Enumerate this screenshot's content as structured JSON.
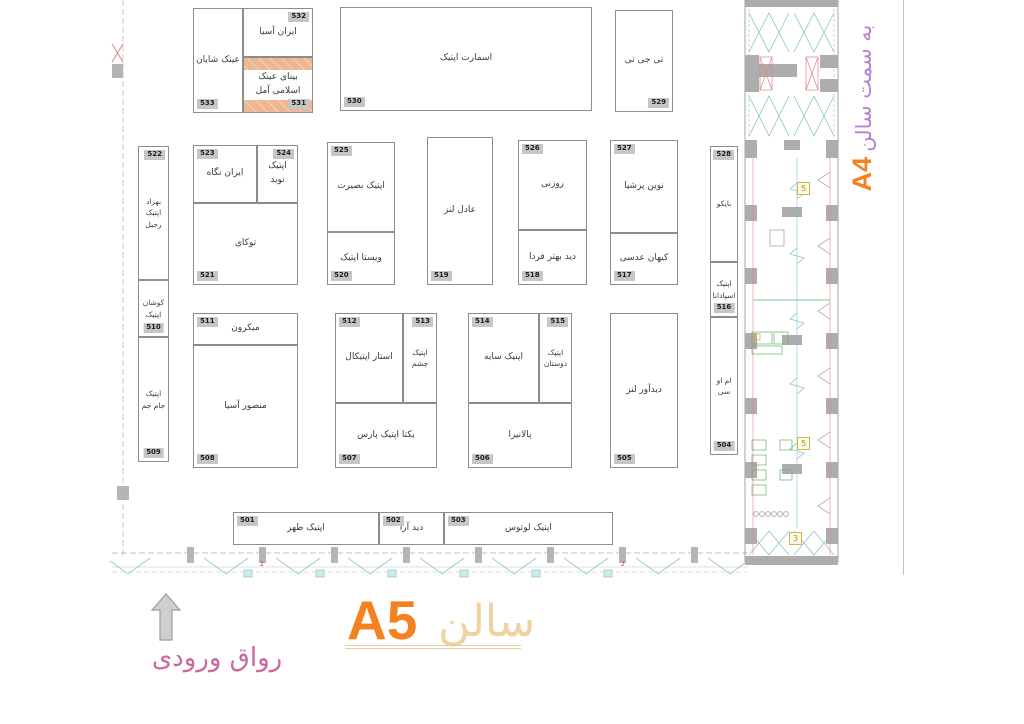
{
  "titles": {
    "hall_latin": "A5",
    "hall_persian": "سالن",
    "direction_persian": "به سمت سالن",
    "direction_hall": "A4",
    "entrance": "رواق ورودی"
  },
  "colors": {
    "accent_orange": "#f58220",
    "title_tan": "#eed3a0",
    "direction_purple": "#b881cb",
    "entrance_pink": "#c9699f",
    "highlight_booth_fill": "#edb795",
    "booth_border": "#8c8c8c"
  },
  "corridor": {
    "badge_1": "5",
    "badge_2": "5",
    "badge_3": "3",
    "wall_mark_1": "2",
    "wall_mark_2": "2"
  },
  "booths": {
    "b533": {
      "number": "533",
      "label": "عینک شایان"
    },
    "b532": {
      "number": "532",
      "label": "ایران آسیا"
    },
    "b531": {
      "number": "531",
      "label": "بینای عینک اسلامی آمل"
    },
    "b530": {
      "number": "530",
      "label": "اسمارت اپتیک"
    },
    "b529": {
      "number": "529",
      "label": "تی جی تی"
    },
    "b528": {
      "number": "528",
      "label": "بایکو"
    },
    "b527": {
      "number": "527",
      "label": "نوین پرشیا"
    },
    "b526": {
      "number": "526",
      "label": "روزنی"
    },
    "b525": {
      "number": "525",
      "label": "اپتیک بصیرت"
    },
    "b524": {
      "number": "524",
      "label": "اپتیک نوید"
    },
    "b523": {
      "number": "523",
      "label": "ایران نگاه"
    },
    "b522": {
      "number": "522",
      "label": "بهزاد اپتیک رجبل"
    },
    "b521": {
      "number": "521",
      "label": "توکای"
    },
    "b520": {
      "number": "520",
      "label": "ویستا اپتیک"
    },
    "b519": {
      "number": "519",
      "label": "عادل لنز"
    },
    "b518": {
      "number": "518",
      "label": "دید بهتر فردا"
    },
    "b517": {
      "number": "517",
      "label": "کیهان عدسی"
    },
    "b516": {
      "number": "516",
      "label": "اپتیک اسپادانا"
    },
    "b515": {
      "number": "515",
      "label": "اپتیک دوستان"
    },
    "b514": {
      "number": "514",
      "label": "اپتیک سایه"
    },
    "b513": {
      "number": "513",
      "label": "اپتیک چشم"
    },
    "b512": {
      "number": "512",
      "label": "استار اپتیکال"
    },
    "b511": {
      "number": "511",
      "label": "میکرون"
    },
    "b510": {
      "number": "510",
      "label": "کوشان اپتیک"
    },
    "b509": {
      "number": "509",
      "label": "اپتیک جام جم"
    },
    "b508": {
      "number": "508",
      "label": "منصور آسیا"
    },
    "b507": {
      "number": "507",
      "label": "یکتا اپتیک پارس"
    },
    "b506": {
      "number": "506",
      "label": "پالانیرا"
    },
    "b505": {
      "number": "505",
      "label": "دیدآور لنز"
    },
    "b504": {
      "number": "504",
      "label": "ام او سی"
    },
    "b503": {
      "number": "503",
      "label": "اپتیک لوتوس"
    },
    "b502": {
      "number": "502",
      "label": "دید آرا"
    },
    "b501": {
      "number": "501",
      "label": "اپتیک طهر"
    }
  }
}
